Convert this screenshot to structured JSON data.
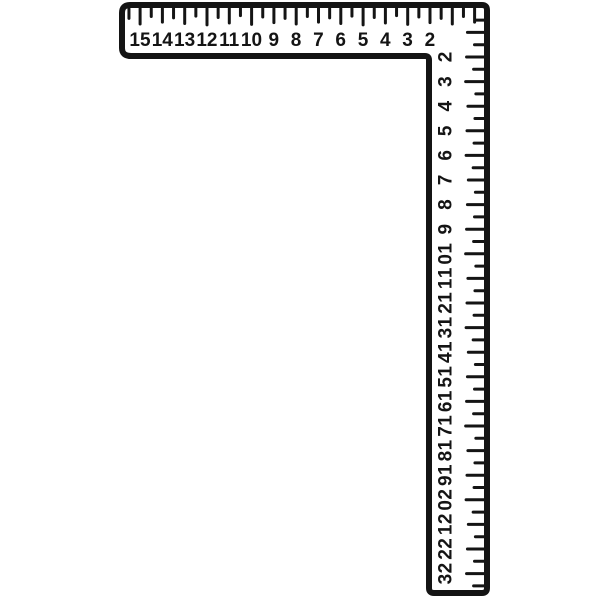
{
  "illustration": {
    "name": "carpenter-framing-square",
    "ink_color": "#141414",
    "paper_color": "#ffffff",
    "horizontal_scale": {
      "numbers": [
        "15",
        "14",
        "13",
        "12",
        "11",
        "10",
        "9",
        "8",
        "7",
        "6",
        "5",
        "4",
        "3",
        "2"
      ]
    },
    "vertical_scale": {
      "numbers": [
        "2",
        "3",
        "4",
        "5",
        "6",
        "7",
        "8",
        "9",
        "10",
        "11",
        "12",
        "13",
        "14",
        "15",
        "16",
        "17",
        "18",
        "19",
        "20",
        "21",
        "22",
        "23"
      ]
    }
  }
}
